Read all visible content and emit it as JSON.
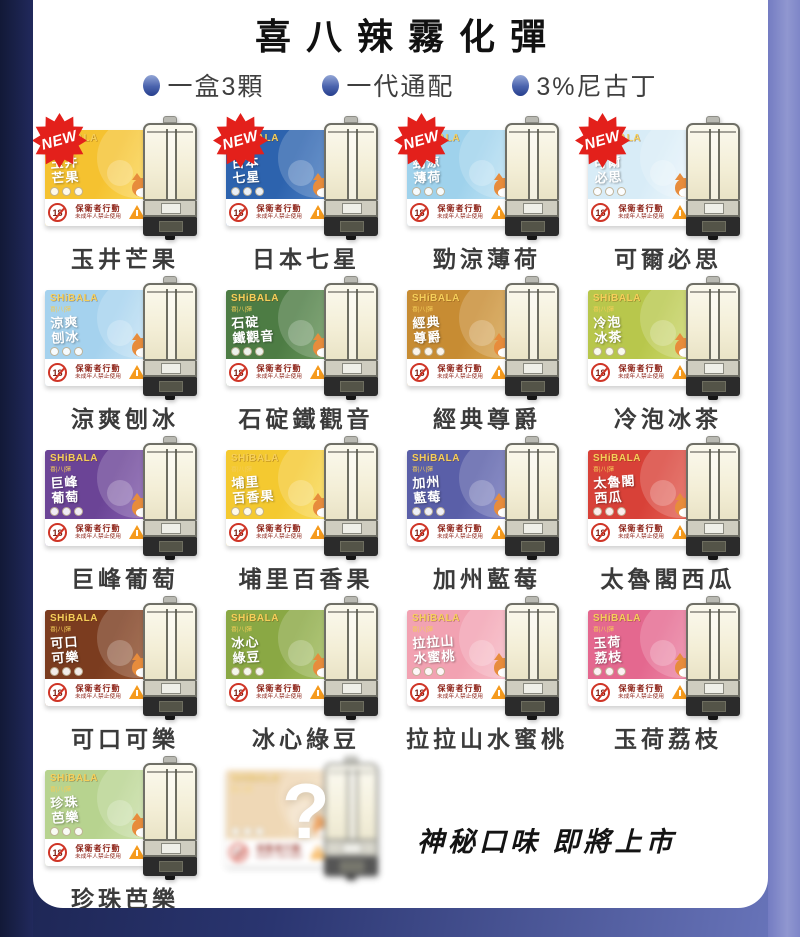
{
  "page": {
    "title": "喜八辣霧化彈"
  },
  "bullets": [
    {
      "text": "一盒3顆"
    },
    {
      "text": "一代通配"
    },
    {
      "text": "3%尼古丁"
    }
  ],
  "brand": {
    "logo": "SHiBALA",
    "sub": "喜|八|彈"
  },
  "badge_new": "NEW",
  "warning": {
    "age": "18",
    "line1": "保衛者行動",
    "line2": "未成年人禁止使用"
  },
  "mystery": {
    "mark": "?",
    "caption": "神秘口味 即將上市"
  },
  "colors": {
    "left_border": "#1b2351",
    "right_border": "#8a90cc",
    "background_gradient_left": "#151c42",
    "background_gradient_right": "#6b77bd",
    "new_badge": "#e3201b",
    "brand_gold": "#f6cf5a",
    "warning_red": "#8c1f14",
    "label_text": "#3b3b3b"
  },
  "products": [
    {
      "name": "玉井芒果",
      "line1": "玉井",
      "line2": "芒果",
      "color": "#f5c230",
      "color2": "#fcdc5e",
      "new": true,
      "mystery": false
    },
    {
      "name": "日本七星",
      "line1": "日本",
      "line2": "七星",
      "color": "#2d63ae",
      "color2": "#4f83c6",
      "new": true,
      "mystery": false
    },
    {
      "name": "勁涼薄荷",
      "line1": "勁涼",
      "line2": "薄荷",
      "color": "#9fd2ec",
      "color2": "#c6e7f6",
      "new": true,
      "mystery": false
    },
    {
      "name": "可爾必思",
      "line1": "可爾",
      "line2": "必思",
      "color": "#d8ecf7",
      "color2": "#f0f8fc",
      "new": true,
      "mystery": false
    },
    {
      "name": "涼爽刨冰",
      "line1": "涼爽",
      "line2": "刨冰",
      "color": "#a5d2ee",
      "color2": "#cfe8f7",
      "new": false,
      "mystery": false
    },
    {
      "name": "石碇鐵觀音",
      "line1": "石碇",
      "line2": "鐵觀音",
      "color": "#4d7c44",
      "color2": "#6f9c60",
      "new": false,
      "mystery": false
    },
    {
      "name": "經典尊爵",
      "line1": "經典",
      "line2": "尊爵",
      "color": "#c78c33",
      "color2": "#dcab55",
      "new": false,
      "mystery": false
    },
    {
      "name": "冷泡冰茶",
      "line1": "冷泡",
      "line2": "冰茶",
      "color": "#b8c74c",
      "color2": "#d2dc74",
      "new": false,
      "mystery": false
    },
    {
      "name": "巨峰葡萄",
      "line1": "巨峰",
      "line2": "葡萄",
      "color": "#6b4496",
      "color2": "#8a64b4",
      "new": false,
      "mystery": false
    },
    {
      "name": "埔里百香果",
      "line1": "埔里",
      "line2": "百香果",
      "color": "#f4c930",
      "color2": "#fadf62",
      "new": false,
      "mystery": false
    },
    {
      "name": "加州藍莓",
      "line1": "加州",
      "line2": "藍莓",
      "color": "#5a5fa8",
      "color2": "#7b7fc2",
      "new": false,
      "mystery": false
    },
    {
      "name": "太魯閣西瓜",
      "line1": "太魯閣",
      "line2": "西瓜",
      "color": "#d84138",
      "color2": "#e66a5c",
      "new": false,
      "mystery": false
    },
    {
      "name": "可口可樂",
      "line1": "可口",
      "line2": "可樂",
      "color": "#7b3c1f",
      "color2": "#9a5a35",
      "new": false,
      "mystery": false
    },
    {
      "name": "冰心綠豆",
      "line1": "冰心",
      "line2": "綠豆",
      "color": "#8aa844",
      "color2": "#a8c263",
      "new": false,
      "mystery": false
    },
    {
      "name": "拉拉山水蜜桃",
      "line1": "拉拉山",
      "line2": "水蜜桃",
      "color": "#f2a2b2",
      "color2": "#f8c3cc",
      "new": false,
      "mystery": false
    },
    {
      "name": "玉荷荔枝",
      "line1": "玉荷",
      "line2": "荔枝",
      "color": "#e4688f",
      "color2": "#ee8fab",
      "new": false,
      "mystery": false
    },
    {
      "name": "珍珠芭樂",
      "line1": "珍珠",
      "line2": "芭樂",
      "color": "#b7d38f",
      "color2": "#d2e4b2",
      "new": false,
      "mystery": false
    },
    {
      "name": "",
      "line1": "",
      "line2": "",
      "color": "#eccfa4",
      "color2": "#f5e2c6",
      "new": false,
      "mystery": true
    }
  ]
}
